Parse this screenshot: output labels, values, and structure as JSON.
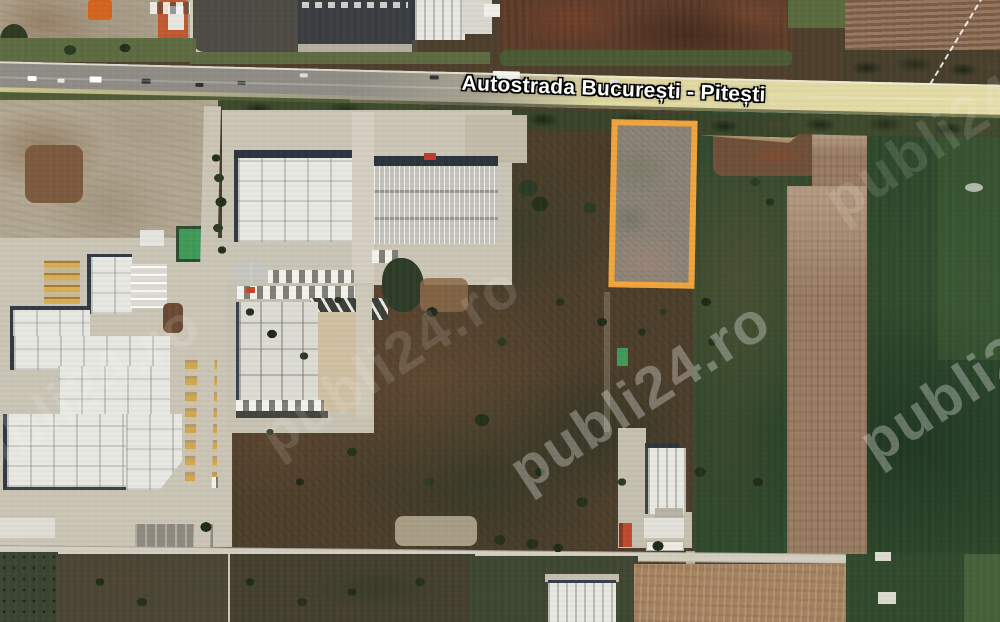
{
  "map": {
    "highway_label": "Autostrada București - Pitești",
    "watermark": {
      "text": "publi24.ro"
    },
    "parcel_outline_color": "#F1A53C",
    "colors": {
      "highway_asphalt": "#8E8C85",
      "highway_concrete": "#E0D9A2",
      "scrubland": "#4E3F2C",
      "field_green": "#2F4A2D",
      "plowed_tan": "#9C7E64",
      "plowed_bottom": "#A5825F",
      "concrete": "#CBC5B6",
      "roof_white": "#E8E8E3",
      "pond_green": "#3F9A58",
      "watermark_white": "#FFFFFF"
    }
  }
}
